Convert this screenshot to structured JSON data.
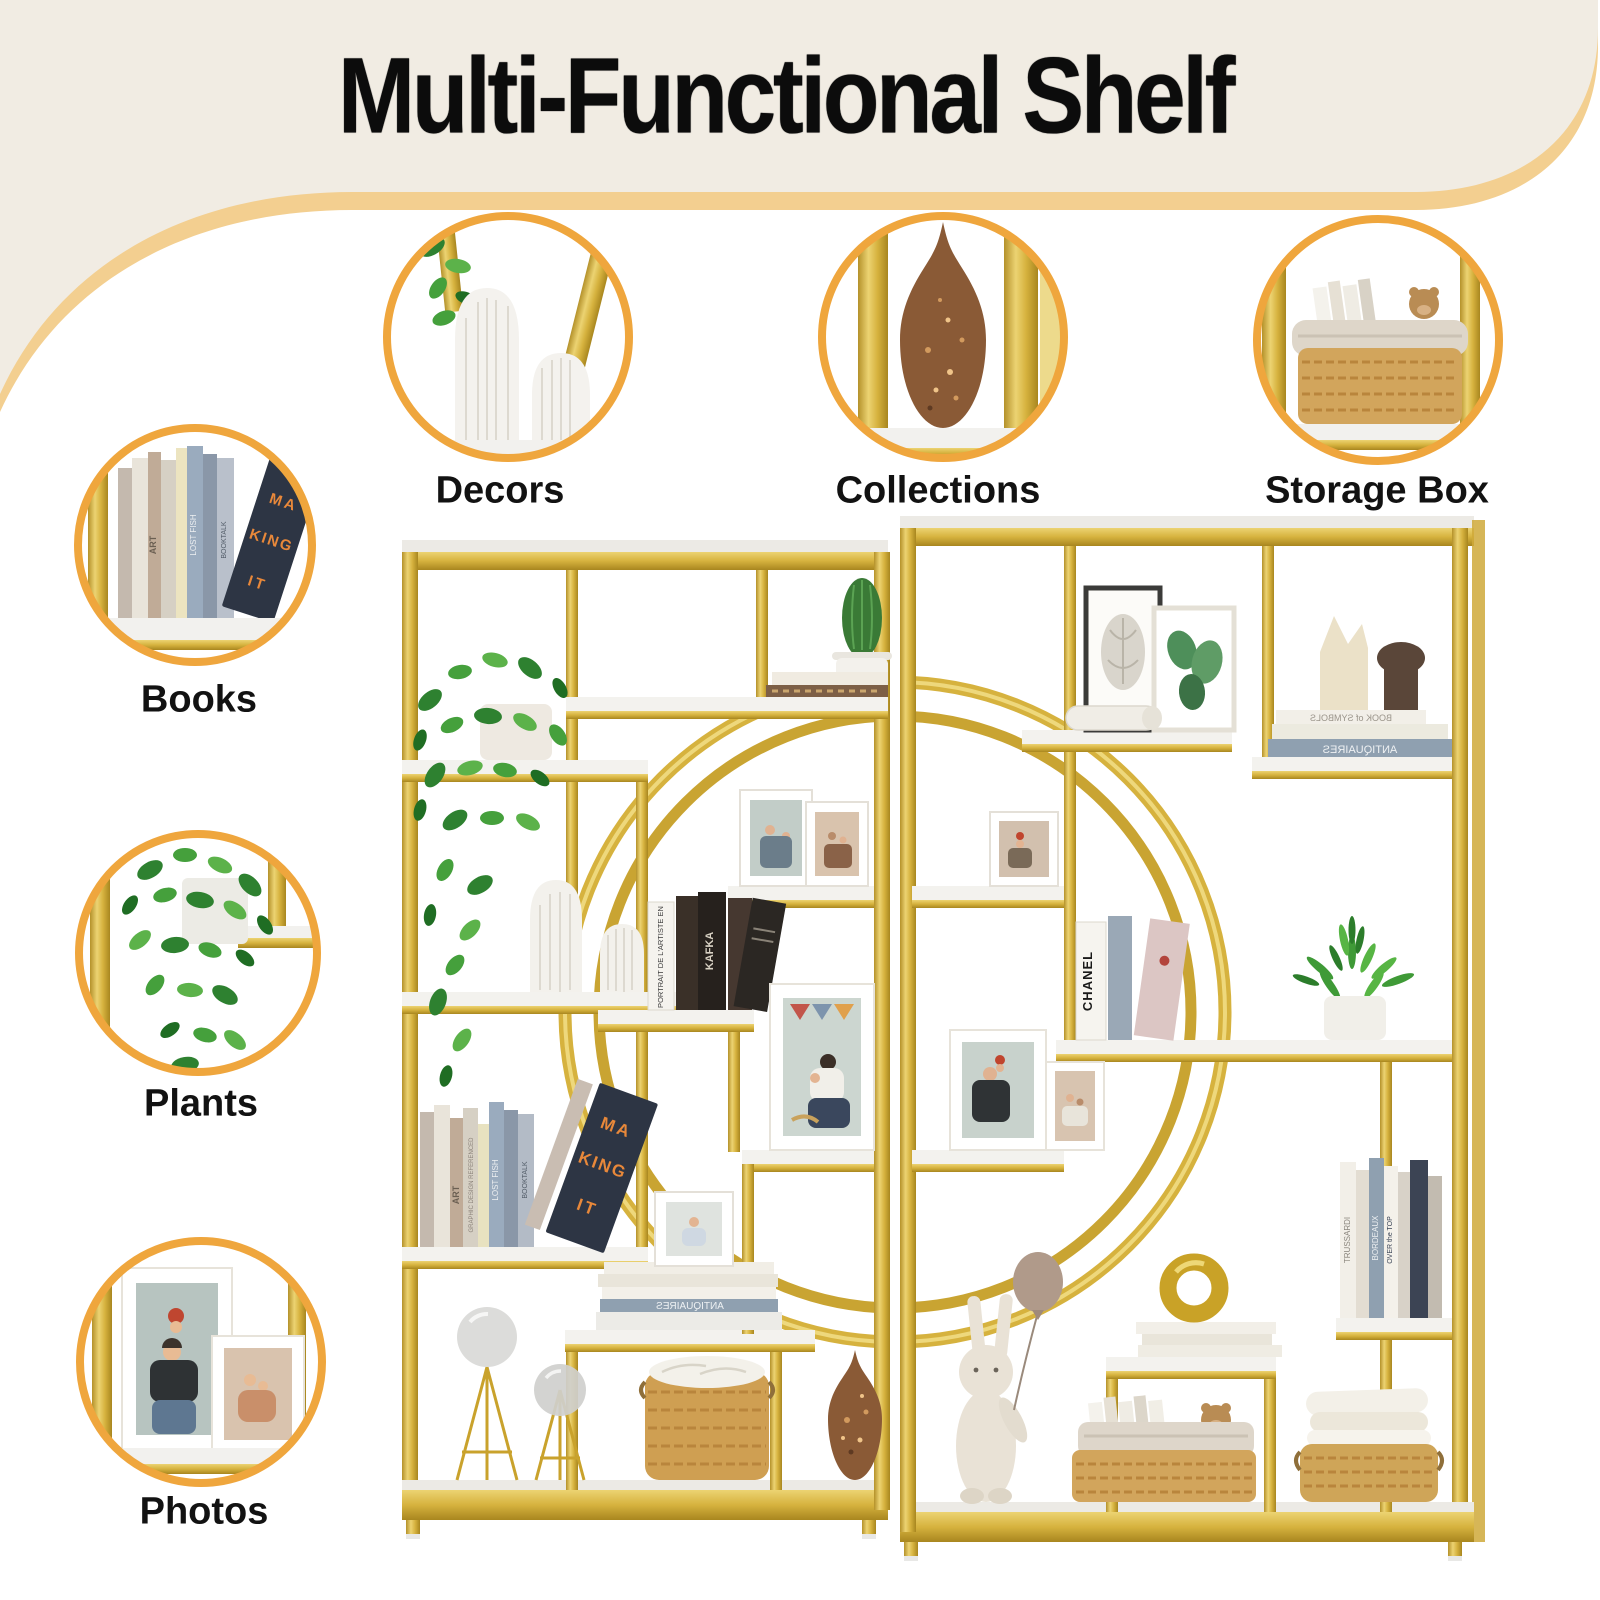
{
  "header": {
    "title": "Multi-Functional Shelf",
    "background_color": "#f1ece3",
    "band_color": "#f3cf90"
  },
  "callouts": {
    "ring_color": "#efa63d",
    "items": [
      {
        "id": "decors",
        "label": "Decors"
      },
      {
        "id": "collections",
        "label": "Collections"
      },
      {
        "id": "storage-box",
        "label": "Storage Box"
      },
      {
        "id": "books",
        "label": "Books"
      },
      {
        "id": "plants",
        "label": "Plants"
      },
      {
        "id": "photos",
        "label": "Photos"
      }
    ]
  },
  "shelf": {
    "frame_gold": "#d6b23e",
    "frame_gold_light": "#eed87c",
    "frame_gold_dark": "#ab8a22",
    "marble_color": "#f3f2ee",
    "book_titles": {
      "making_line1": "MA",
      "making_line2": "KING",
      "making_line3": "IT",
      "art": "ART",
      "lost_fish": "LOST FISH",
      "booktalk": "BOOKTALK",
      "graphic": "GRAPHIC DESIGN REFERENCED",
      "portrait": "PORTRAIT DE L'ARTISTE EN",
      "kafka": "KAFKA",
      "chanel": "CHANEL",
      "antiquaires": "ANTIQUAIRES",
      "book_of_symbols": "BOOK of SYMBOLS",
      "trussardi": "TRUSSARDI",
      "bordeaux": "BORDEAUX",
      "over_the_top": "OVER the TOP"
    }
  }
}
